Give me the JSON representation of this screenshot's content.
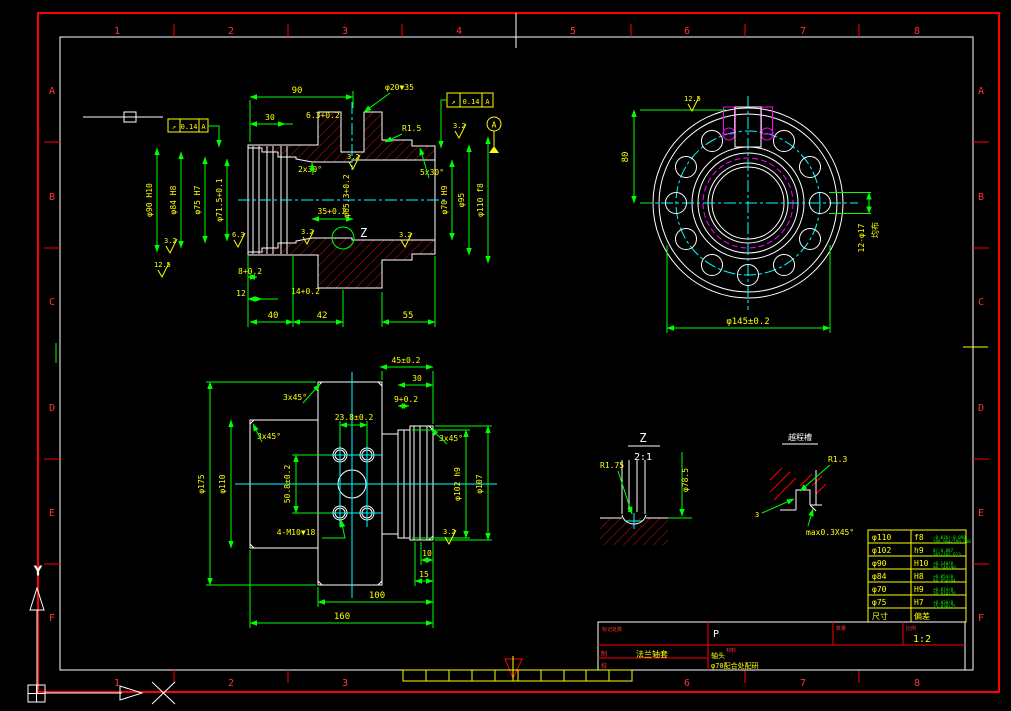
{
  "frame": {
    "cols": [
      "1",
      "2",
      "3",
      "4",
      "5",
      "6",
      "7",
      "8"
    ],
    "bottom_cols": [
      "1",
      "2",
      "3",
      "6",
      "7",
      "8"
    ],
    "rows": [
      "A",
      "B",
      "C",
      "D",
      "E",
      "F"
    ],
    "ucs": {
      "x_label": "X",
      "y_label": "Y"
    }
  },
  "v1": {
    "top_len": "90",
    "hole": "φ20▼35",
    "len30": "30",
    "d63": "6.3+0.2",
    "r15": "R1.5",
    "ch2": "2x30°",
    "ch5": "5x30°",
    "len35": "35+0.2",
    "d653": "φ65.3+0.2",
    "d90": "φ90 H10",
    "d84": "φ84 H8",
    "d75": "φ75 H7",
    "d715": "φ71.5+0.1",
    "d70": "φ70 H9",
    "d95": "φ95",
    "d110": "φ110 f8",
    "l8": "8+0.2",
    "l12": "12",
    "l14": "14+0.2",
    "l40": "40",
    "l42": "42",
    "l55": "55",
    "z": "Z",
    "fcf_sym": "↗",
    "fcf_val": "0.14",
    "fcf_ref": "A",
    "datum": "A",
    "r1": "3.2",
    "r2": "12.5",
    "r3": "6.3",
    "r4": "3.2",
    "r5": "3.2",
    "r6": "3.2",
    "r7": "3.2"
  },
  "v2": {
    "len80": "80",
    "holes": "12-φ17",
    "note": "均布",
    "d145": "φ145±0.2",
    "rough": "12.5"
  },
  "v3": {
    "len45": "45±0.2",
    "len30": "30",
    "len9": "9+0.2",
    "len238": "23.8±0.2",
    "ch1": "3x45°",
    "ch2": "3x45°",
    "ch3": "3x45°",
    "len508": "50.8±0.2",
    "d175": "φ175",
    "d110": "φ110",
    "d102": "φ102 h9",
    "d107": "φ107",
    "holes": "4-M10▼18",
    "l10": "10",
    "l15": "15",
    "l100": "100",
    "l160": "160",
    "rough": "3.2"
  },
  "v4": {
    "label": "Z",
    "scale": "2:1",
    "r": "R1.75",
    "dia": "φ78.5"
  },
  "v5": {
    "title": "越程槽",
    "r": "R1.3",
    "w": "3",
    "ch": "max0.3X45°"
  },
  "table": {
    "size_label": "尺寸",
    "fit_label": "偏差",
    "rows": [
      {
        "size": "φ110",
        "fit": "f8",
        "dev": "-0.036/-0.090",
        "lim": "109.964/109.910"
      },
      {
        "size": "φ102",
        "fit": "h9",
        "dev": "0/-0.087",
        "lim": "102/101.913"
      },
      {
        "size": "φ90",
        "fit": "H10",
        "dev": "+0.140/0",
        "lim": "90.140/90"
      },
      {
        "size": "φ84",
        "fit": "H8",
        "dev": "+0.054/0",
        "lim": "84.054/84"
      },
      {
        "size": "φ70",
        "fit": "H9",
        "dev": "+0.074/0",
        "lim": "70.074/70"
      },
      {
        "size": "φ75",
        "fit": "H7",
        "dev": "+0.030/0",
        "lim": "75.030/75"
      }
    ]
  },
  "tb": {
    "rec": "标记处数",
    "code": "P",
    "qty_label": "数量",
    "scale_label": "比例",
    "scale": "1:2",
    "mat_label": "材料",
    "draw_label": "制",
    "check_label": "校",
    "name": "法兰轴套",
    "note1": "轴头",
    "note2": "φ70配合处配研"
  }
}
